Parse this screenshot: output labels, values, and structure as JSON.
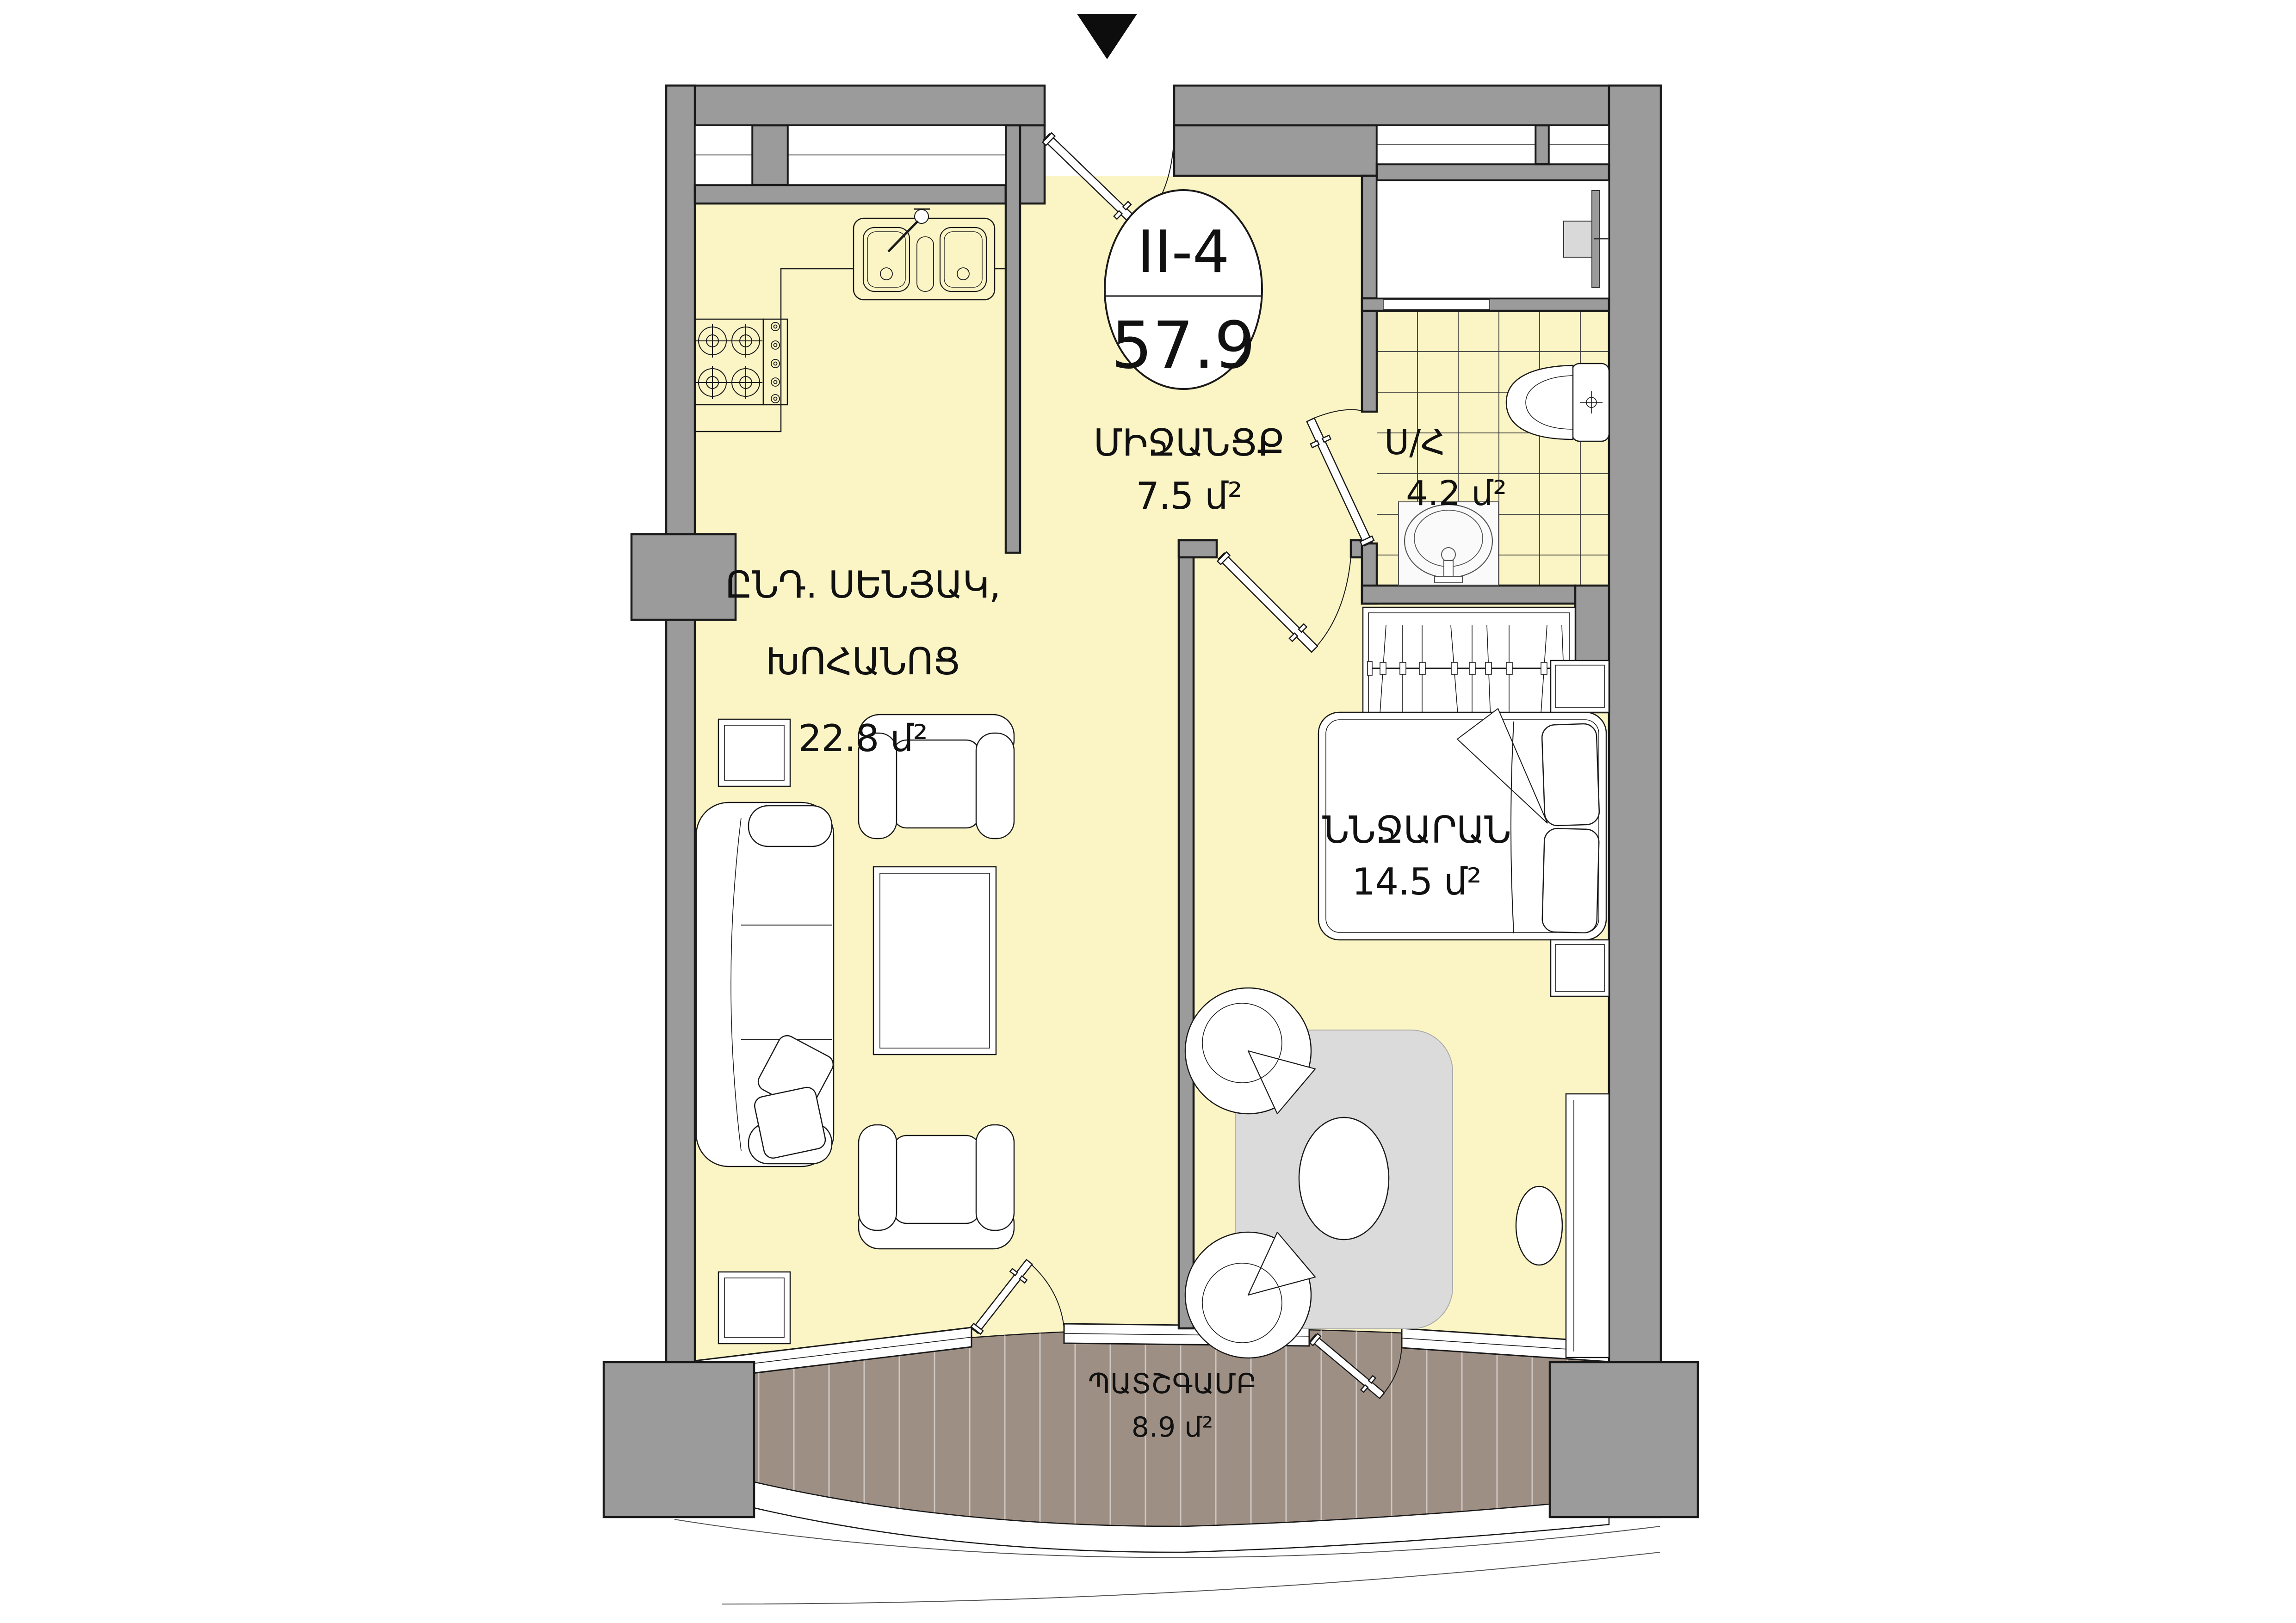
{
  "unit_badge": {
    "code": "II-4",
    "total_area": "57.9"
  },
  "rooms": {
    "hallway": {
      "name": "ՄԻՋԱՆՑՔ",
      "area": "7.5 մ²"
    },
    "bathroom": {
      "name": "Ս/Հ",
      "area": "4.2 մ²"
    },
    "living_kitchen": {
      "name_line1": "ԸՆԴ. ՍԵՆՅԱԿ,",
      "name_line2": "ԽՈՀԱՆՈՑ",
      "area": "22.8 մ²"
    },
    "bedroom": {
      "name": "ՆՆՋԱՐԱՆ",
      "area": "14.5 մ²"
    },
    "balcony": {
      "name": "ՊԱՏՇԳԱՄԲ",
      "area": "8.9 մ²"
    }
  },
  "icons": {
    "orientation_marker": "north-triangle-marker"
  },
  "colors": {
    "wall_gray": "#9B9B9B",
    "floor_yellow": "#FBF5C5",
    "balcony_brown": "#9E8F84",
    "rug_gray": "#DBDBDB",
    "outline_black": "#1a1a1a",
    "background": "#ffffff"
  }
}
